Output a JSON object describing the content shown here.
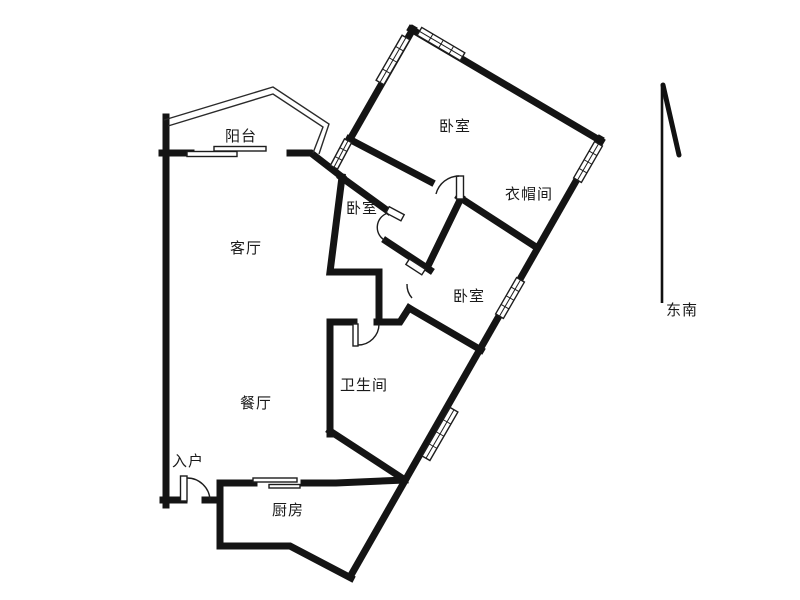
{
  "floor_plan": {
    "type": "apartment-floor-plan",
    "rooms": [
      {
        "id": "balcony",
        "label": "阳台"
      },
      {
        "id": "living-room",
        "label": "客厅"
      },
      {
        "id": "bedroom-top",
        "label": "卧室"
      },
      {
        "id": "bedroom-middle",
        "label": "卧室"
      },
      {
        "id": "bedroom-right",
        "label": "卧室"
      },
      {
        "id": "cloakroom",
        "label": "衣帽间"
      },
      {
        "id": "dining-room",
        "label": "餐厅"
      },
      {
        "id": "bathroom",
        "label": "卫生间"
      },
      {
        "id": "entrance",
        "label": "入户"
      },
      {
        "id": "kitchen",
        "label": "厨房"
      }
    ],
    "compass": {
      "direction_label": "东南"
    },
    "colors": {
      "wall": "#141414",
      "background": "#ffffff",
      "label_text": "#1a1a1a"
    }
  }
}
